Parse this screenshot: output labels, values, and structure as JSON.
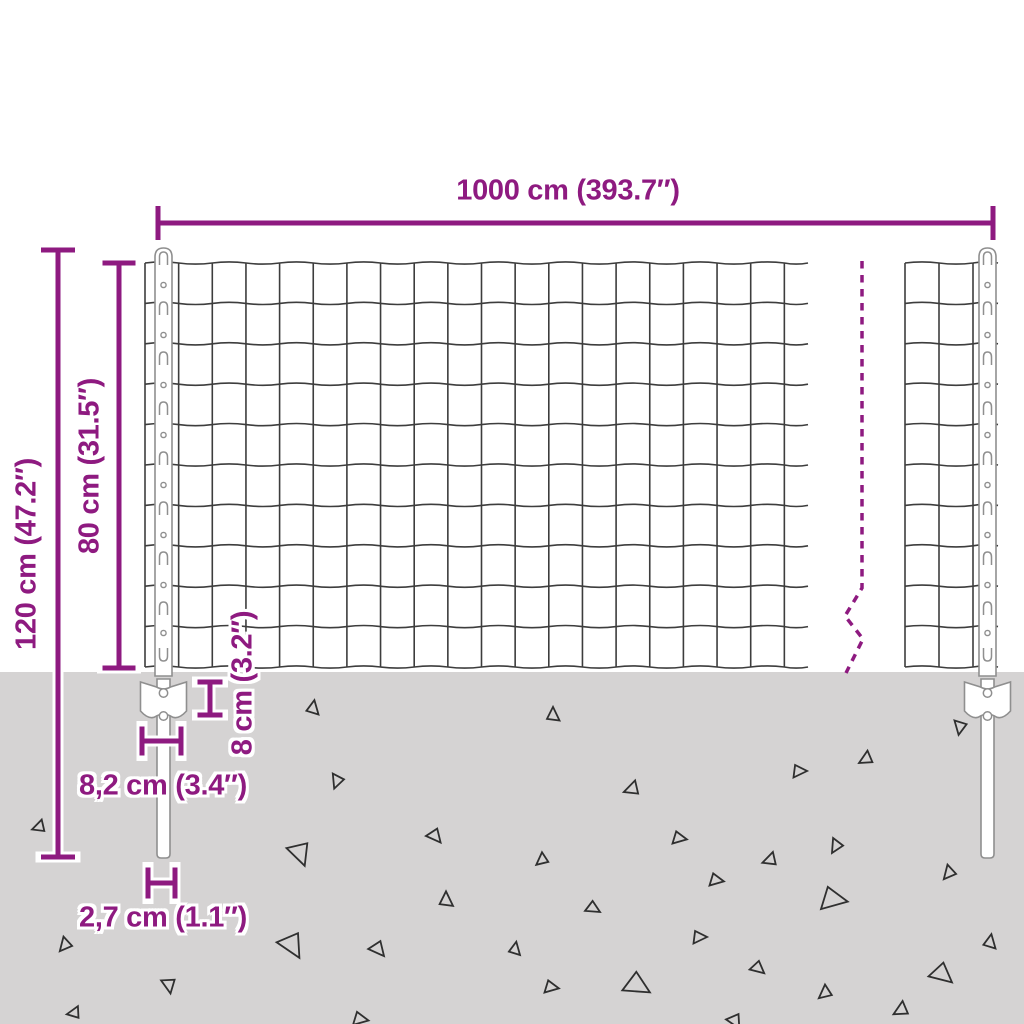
{
  "diagram": {
    "type": "fence-panel-dimension-diagram",
    "labels": {
      "width_total": "1000 cm (393.7″)",
      "height_total": "120 cm (47.2″)",
      "height_mesh": "80 cm (31.5″)",
      "anchor_height": "8 cm (3.2″)",
      "anchor_width": "8,2 cm (3.4″)",
      "spike_width": "2,7 cm (1.1″)"
    },
    "colors": {
      "accent": "#8e1a80",
      "ground": "#d5d3d3",
      "wire": "#3d3d3d",
      "post_stroke": "#8f8f8f",
      "post_fill": "#ffffff",
      "triangle": "#2f2f2f",
      "background": "#ffffff"
    },
    "geometry": {
      "canvas": {
        "w": 1024,
        "h": 1024
      },
      "ground": {
        "y": 672
      },
      "mesh": {
        "row_y0": 263,
        "row_step": 40.4,
        "row_count": 11,
        "wave_amp": 2.2,
        "panels": [
          {
            "hx1": 145,
            "hx2": 808,
            "col_x0": 145,
            "col_step": 33.65,
            "col_count": 20
          },
          {
            "hx1": 905,
            "hx2": 998,
            "col_x0": 905,
            "col_step": 34,
            "col_count": 3
          }
        ]
      },
      "posts": [
        {
          "cx": 163.5
        },
        {
          "cx": 987.5
        }
      ],
      "post_style": {
        "top_y": 248,
        "width": 17,
        "body_bottom": 676,
        "spike_w": 13,
        "spike_bottom": 858,
        "plate_top": 679,
        "plate_bottom": 721,
        "plate_half_w": 23,
        "clip_ys": [
          258,
          308,
          358,
          408,
          458,
          508,
          558,
          608,
          655
        ],
        "hole_ys": [
          285,
          335,
          385,
          435,
          485,
          535,
          585,
          633
        ],
        "plate_hole_ys": [
          693,
          716
        ]
      },
      "break_line": {
        "points": [
          [
            862,
            261
          ],
          [
            862,
            588
          ],
          [
            845,
            616
          ],
          [
            863,
            639
          ],
          [
            846,
            673
          ]
        ],
        "dash": "7.5 6.5",
        "width": 3.5
      },
      "dimensions": [
        {
          "id": "total_width",
          "orient": "h",
          "y": 223,
          "a": 158,
          "b": 993,
          "tick": 34,
          "lw": 5
        },
        {
          "id": "height_total",
          "orient": "v",
          "x": 58,
          "a": 250,
          "b": 857,
          "tick": 34,
          "lw": 5
        },
        {
          "id": "height_mesh",
          "orient": "v",
          "x": 119,
          "a": 263,
          "b": 668,
          "tick": 33,
          "lw": 5
        },
        {
          "id": "anchor_height",
          "orient": "v",
          "x": 210,
          "a": 682,
          "b": 715,
          "tick": 25,
          "lw": 5
        },
        {
          "id": "anchor_width",
          "orient": "h",
          "y": 741,
          "a": 142,
          "b": 181,
          "tick": 29,
          "lw": 5
        },
        {
          "id": "spike_width",
          "orient": "h",
          "y": 883,
          "a": 148,
          "b": 175,
          "tick": 31,
          "lw": 5
        }
      ],
      "triangles": [
        [
          313,
          708,
          13,
          10
        ],
        [
          337,
          781,
          13,
          200
        ],
        [
          39,
          827,
          12,
          250
        ],
        [
          300,
          853,
          22,
          160
        ],
        [
          435,
          836,
          14,
          140
        ],
        [
          446,
          900,
          14,
          0
        ],
        [
          65,
          945,
          13,
          220
        ],
        [
          292,
          945,
          24,
          150
        ],
        [
          378,
          949,
          15,
          140
        ],
        [
          169,
          985,
          14,
          170
        ],
        [
          74,
          1013,
          12,
          260
        ],
        [
          360,
          1019,
          14,
          100
        ],
        [
          553,
          715,
          13,
          0
        ],
        [
          866,
          759,
          13,
          240
        ],
        [
          799,
          771,
          13,
          90
        ],
        [
          632,
          789,
          14,
          250
        ],
        [
          679,
          838,
          13,
          100
        ],
        [
          836,
          846,
          13,
          210
        ],
        [
          770,
          860,
          13,
          250
        ],
        [
          542,
          860,
          12,
          230
        ],
        [
          716,
          880,
          13,
          100
        ],
        [
          949,
          873,
          13,
          220
        ],
        [
          593,
          908,
          13,
          120
        ],
        [
          833,
          899,
          24,
          100
        ],
        [
          699,
          937,
          13,
          90
        ],
        [
          515,
          949,
          12,
          10
        ],
        [
          758,
          968,
          13,
          130
        ],
        [
          551,
          987,
          13,
          100
        ],
        [
          637,
          985,
          24,
          120
        ],
        [
          825,
          993,
          13,
          230
        ],
        [
          942,
          974,
          21,
          130
        ],
        [
          990,
          942,
          13,
          10
        ],
        [
          960,
          727,
          13,
          190
        ],
        [
          901,
          1010,
          14,
          240
        ],
        [
          735,
          1021,
          14,
          150
        ]
      ]
    }
  }
}
